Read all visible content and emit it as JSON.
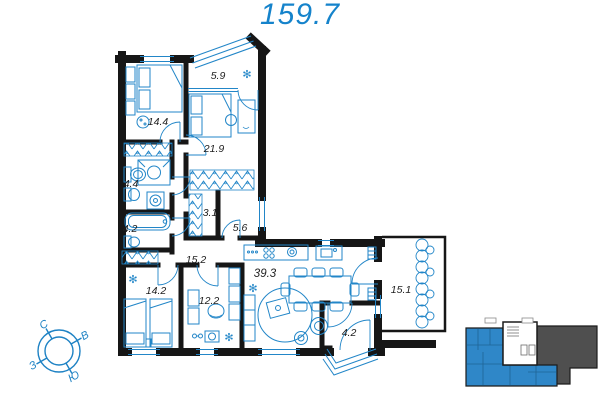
{
  "title": {
    "total_area": "159.7"
  },
  "plan": {
    "rooms": [
      {
        "id": "loggia",
        "area": "5.9"
      },
      {
        "id": "bedroom-1",
        "area": "14.4"
      },
      {
        "id": "bedroom-2",
        "area": "21.9"
      },
      {
        "id": "bathroom-1",
        "area": "4.4"
      },
      {
        "id": "wardrobe-room",
        "area": "3.1"
      },
      {
        "id": "hall-nook",
        "area": "5.6"
      },
      {
        "id": "bathroom-2",
        "area": "4.2"
      },
      {
        "id": "corridor",
        "area": "15.2"
      },
      {
        "id": "bedroom-3",
        "area": "14.2"
      },
      {
        "id": "bedroom-4",
        "area": "12.2"
      },
      {
        "id": "living-kitchen",
        "area": "39.3"
      },
      {
        "id": "entrance-hall",
        "area": "4.2"
      },
      {
        "id": "terrace",
        "area": "15.1"
      }
    ]
  },
  "compass": {
    "north": "С",
    "east": "В",
    "south": "Ю",
    "west": "З"
  },
  "icons": {
    "plant": "✻"
  },
  "colors": {
    "line_blue": "#2286c8",
    "title_blue": "#1583cb",
    "wall_black": "#161616",
    "minimap_blue": "#2f87c8",
    "minimap_gray": "#4f4f4f"
  }
}
